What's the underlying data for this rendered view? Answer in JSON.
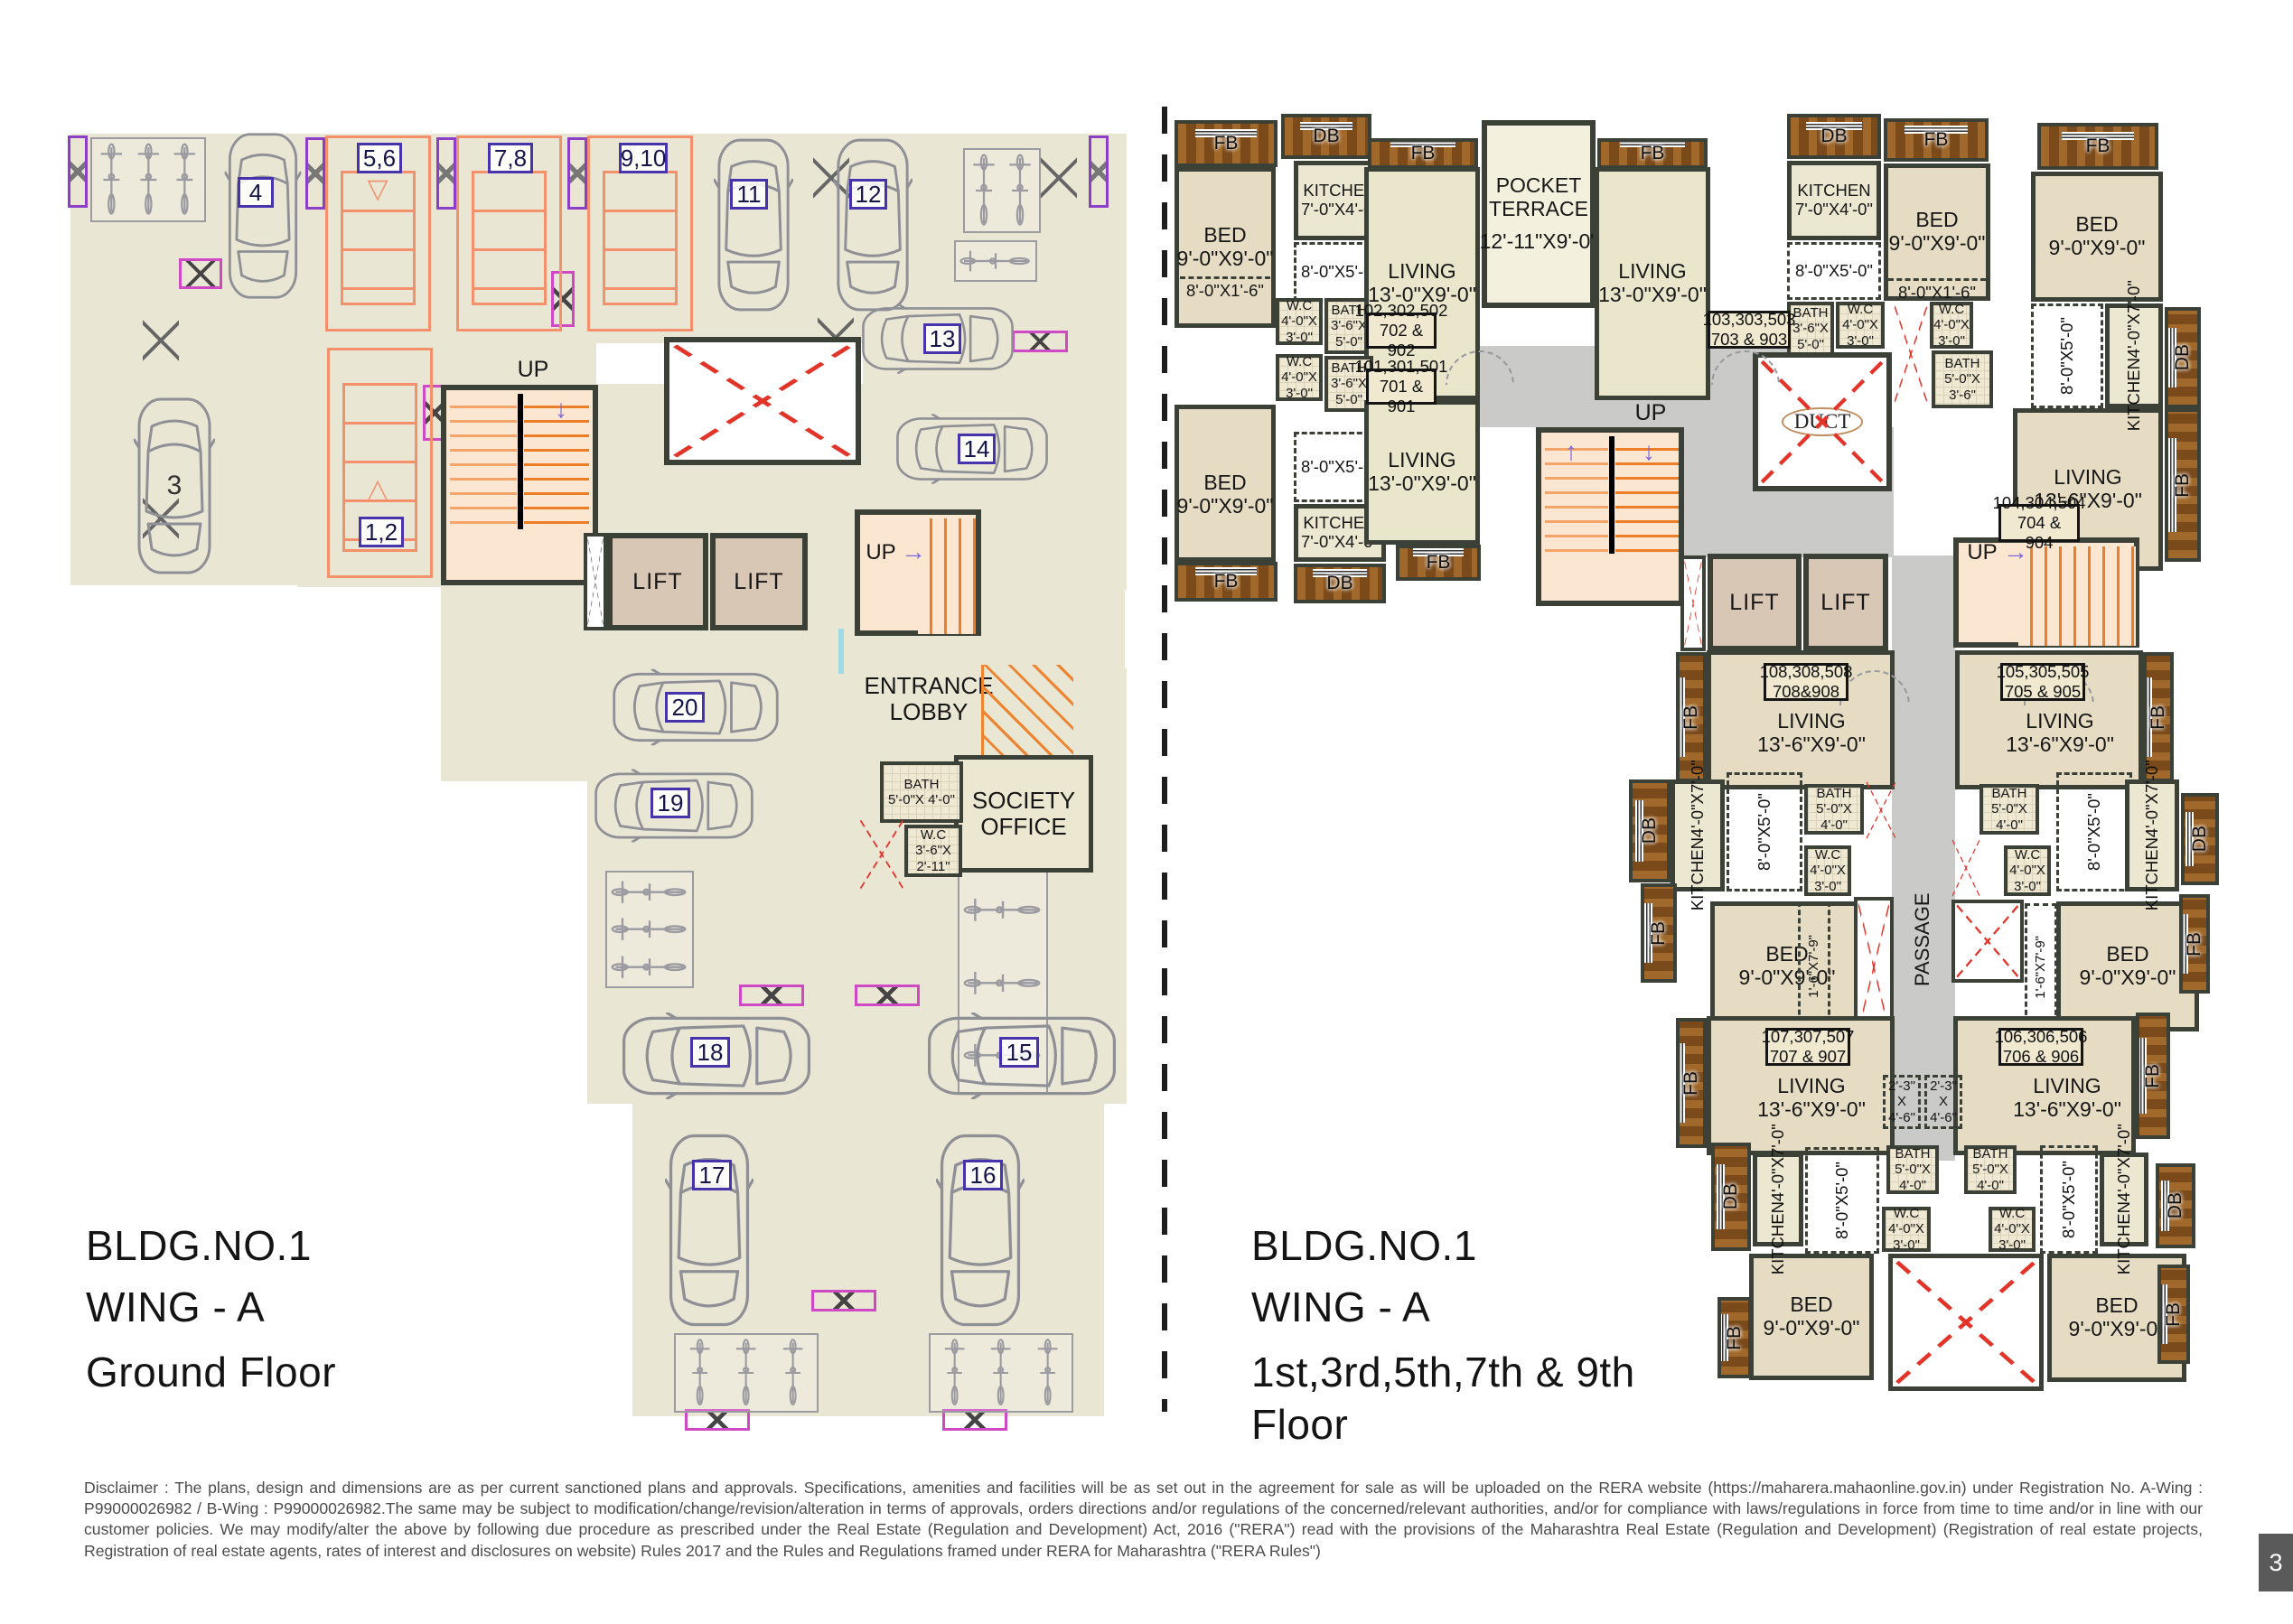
{
  "ground": {
    "title1": "BLDG.NO.1",
    "title2": "WING - A",
    "title3": "Ground Floor",
    "up": "UP",
    "lift": "LIFT",
    "entrance1": "ENTRANCE",
    "entrance2": "LOBBY",
    "society1": "SOCIETY",
    "society2": "OFFICE",
    "bath_name": "BATH",
    "bath_dims": "5'-0\"X 4'-0\"",
    "wc_name": "W.C",
    "wc_dims": "3'-6\"X 2'-11\"",
    "parking": {
      "s12": "1,2",
      "c3": "3",
      "c4": "4",
      "s56": "5,6",
      "s78": "7,8",
      "s910": "9,10",
      "c11": "11",
      "c12": "12",
      "c13": "13",
      "c14": "14",
      "c15": "15",
      "c16": "16",
      "c17": "17",
      "c18": "18",
      "c19": "19",
      "c20": "20"
    }
  },
  "typical": {
    "title1": "BLDG.NO.1",
    "title2": "WING - A",
    "title3": "1st,3rd,5th,7th & 9th",
    "title4": "Floor",
    "up": "UP",
    "lift": "LIFT",
    "duct": "DUCT",
    "passage": "PASSAGE",
    "fb": "FB",
    "db": "DB",
    "pocket1": "POCKET",
    "pocket2": "TERRACE",
    "pocket_dims": "12'-11\"X9'-0\"",
    "bed_name": "BED",
    "bed_dims": "9'-0\"X9'-0\"",
    "kitchen74_name": "KITCHEN",
    "kitchen74_dims": "7'-0\"X4'-0\"",
    "kitchen47_name": "KITCHEN",
    "kitchen47_dims": "4'-0\"X7'-0\"",
    "living130_name": "LIVING",
    "living130_dims": "13'-0\"X9'-0\"",
    "living136_name": "LIVING",
    "living136_dims": "13'-6\"X9'-0\"",
    "bath3650_name": "BATH",
    "bath3650_dims": "3'-6\"X 5'-0\"",
    "bath5040_name": "BATH",
    "bath5040_dims": "5'-0\"X 4'-0\"",
    "bath5036_name": "BATH",
    "bath5036_dims": "5'-0\"X 3'-6\"",
    "wc_name": "W.C",
    "wc_dims": "4'-0\"X 3'-0\"",
    "d8x5": "8'-0\"X5'-0\"",
    "d8x16": "8'-0\"X1'-6\"",
    "d1679": "1'-6\"X7'-9\"",
    "d2346a": "2'-3\"",
    "d2346b": "X",
    "d2346c": "4'-6\"",
    "units": {
      "u101a": "101,301,501",
      "u101b": "701 & 901",
      "u102a": "102,302,502",
      "u102b": "702 & 902",
      "u103a": "103,303,503",
      "u103b": "703 & 903",
      "u104a": "104,304,504",
      "u104b": "704 & 904",
      "u105a": "105,305,505",
      "u105b": "705 & 905",
      "u106a": "106,306,506",
      "u106b": "706 & 906",
      "u107a": "107,307,507",
      "u107b": "707 & 907",
      "u108a": "108,308,508",
      "u108b": "708&908"
    }
  },
  "icons": {
    "arrow_down_tri": "▽",
    "arrow_up_tri": "△",
    "arrow_up": "↑",
    "arrow_down": "↓",
    "arrow_right": "→"
  },
  "footer": {
    "disclaimer": "Disclaimer : The plans, design and dimensions are as per current sanctioned plans and approvals. Specifications, amenities and facilities will be as set out in the agreement for sale as will be uploaded on the RERA website (https://maharera.mahaonline.gov.in) under Registration No. A-Wing : P99000026982 / B-Wing : P99000026982.The same may be subject to modification/change/revision/alteration in terms of approvals, orders directions and/or regulations of the concerned/relevant authorities, and/or for compliance with laws/regulations in force from time to time and/or in line with our customer policies. We may modify/alter the above by following due procedure as prescribed under the Real Estate (Regulation and Development) Act, 2016 (\"RERA\") read with the provisions of the Maharashtra Real Estate (Regulation and Development) (Registration of real estate projects, Registration of real estate agents, rates of interest and disclosures on website) Rules 2017 and the Rules and Regulations framed under RERA for Maharashtra (\"RERA Rules\")",
    "page": "3"
  }
}
